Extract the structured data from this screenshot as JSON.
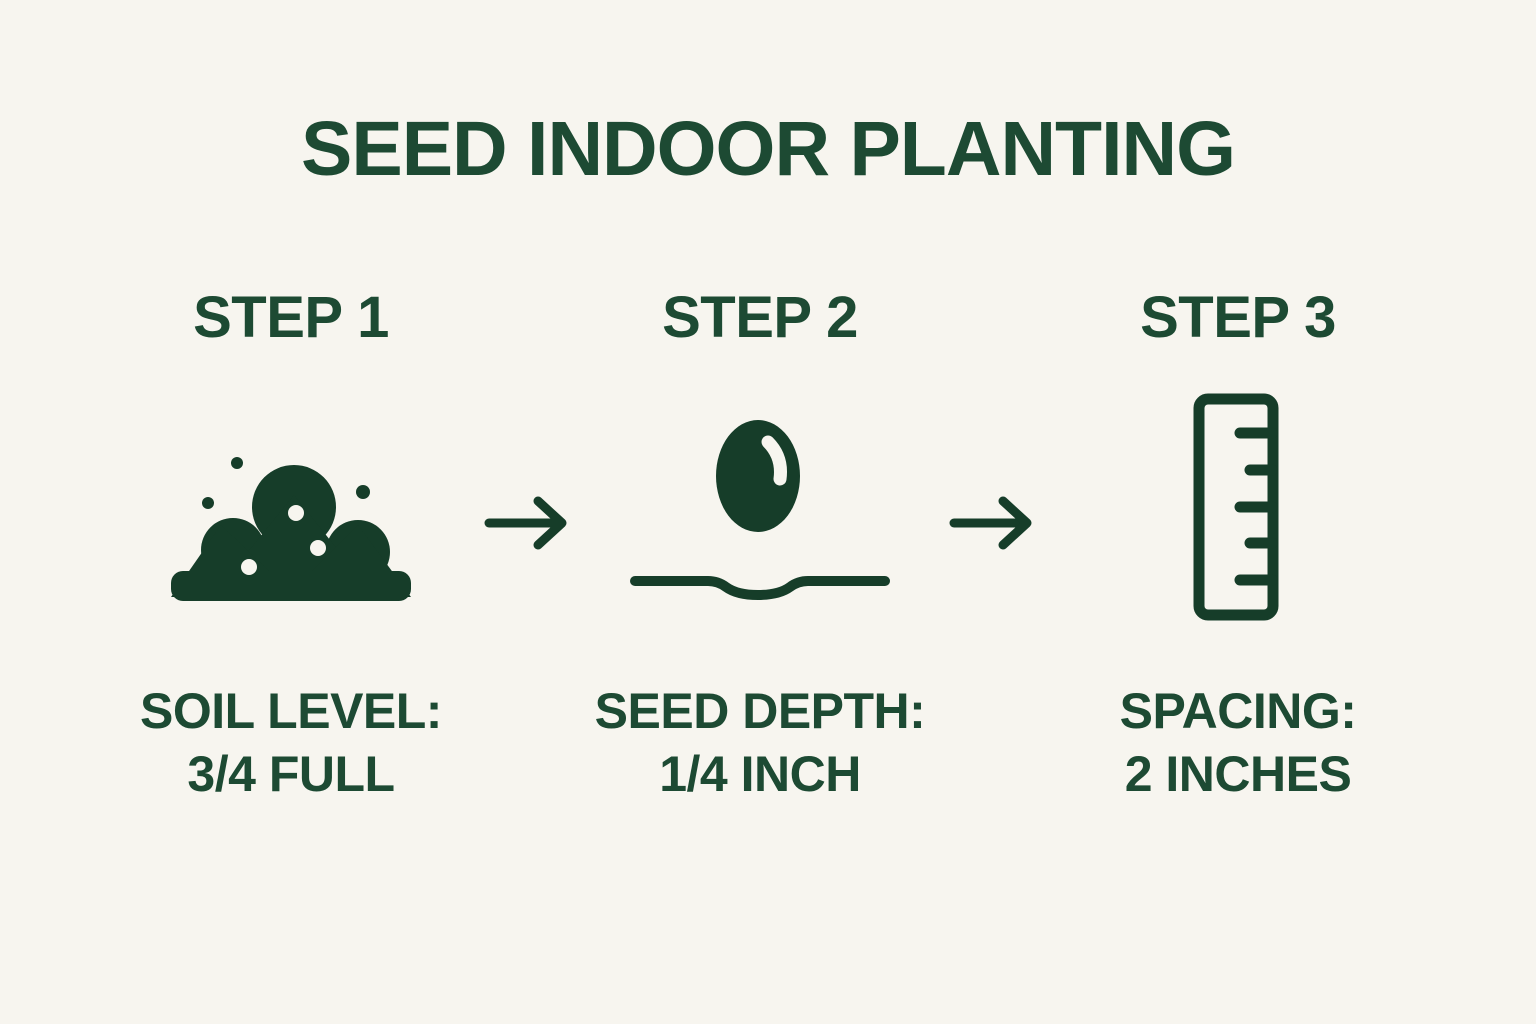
{
  "page": {
    "background": "#f7f5ef",
    "text_color": "#1d4a33",
    "icon_color": "#163d29"
  },
  "title": "SEED INDOOR PLANTING",
  "steps": [
    {
      "heading": "STEP 1",
      "icon": "soil-pile-icon",
      "caption": {
        "line1": "SOIL LEVEL:",
        "line2": "3/4 FULL"
      }
    },
    {
      "heading": "STEP 2",
      "icon": "seed-in-furrow-icon",
      "caption": {
        "line1": "SEED DEPTH:",
        "line2": "1/4 INCH"
      }
    },
    {
      "heading": "STEP 3",
      "icon": "ruler-icon",
      "caption": {
        "line1": "SPACING:",
        "line2": "2 INCHES"
      }
    }
  ],
  "arrows": [
    {
      "icon": "right-arrow-icon"
    },
    {
      "icon": "right-arrow-icon"
    }
  ]
}
